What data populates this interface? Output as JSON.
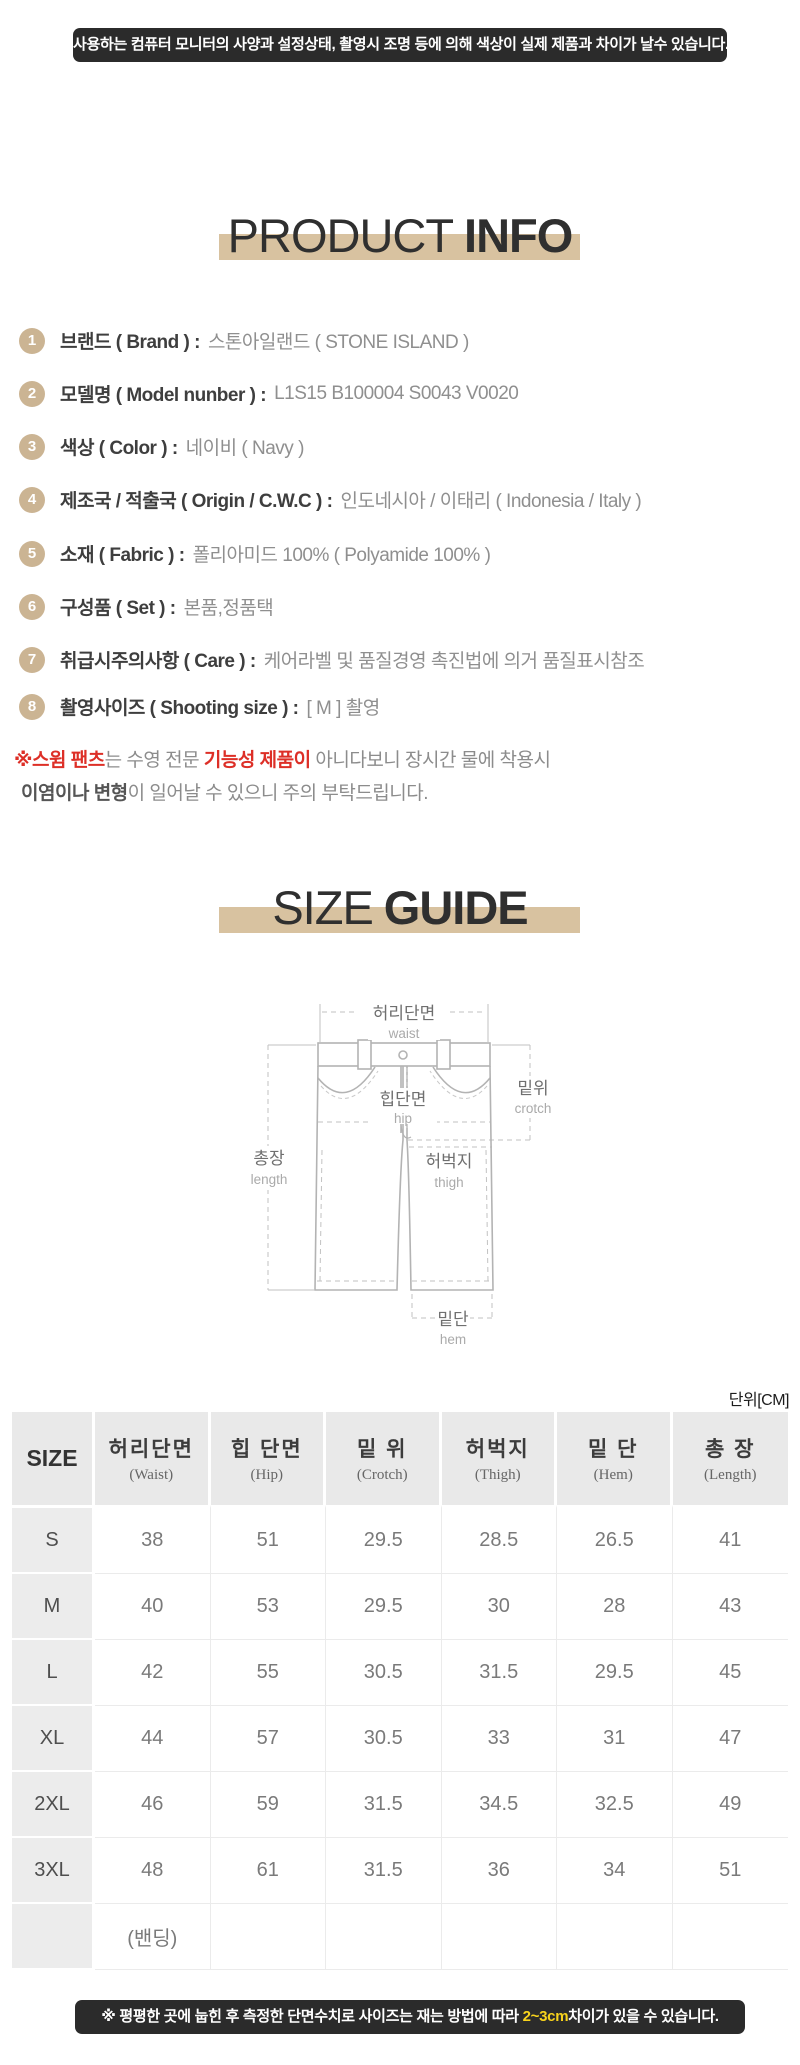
{
  "colors": {
    "accent_tan": "#d8c2a0",
    "badge_tan": "#cbb493",
    "banner_bg": "#2b2b2b",
    "note_red": "#dd2f27",
    "highlight_yellow": "#f8d31c"
  },
  "top_banner": {
    "text": "사용하는 컴퓨터 모니터의 사양과 설정상태, 촬영시 조명 등에 의해 색상이 실제 제품과 차이가 날수 있습니다."
  },
  "product_info": {
    "title": {
      "light": "PRODUCT",
      "bold": "INFO"
    },
    "items": [
      {
        "num": "1",
        "label": "브랜드 ( Brand ) :",
        "value": "스톤아일랜드 ( STONE ISLAND )"
      },
      {
        "num": "2",
        "label": "모델명 ( Model nunber ) :",
        "value": "L1S15 B100004 S0043 V0020"
      },
      {
        "num": "3",
        "label": "색상 ( Color ) :",
        "value": "네이비 ( Navy )"
      },
      {
        "num": "4",
        "label": "제조국 / 적출국 ( Origin / C.W.C ) :",
        "value": "인도네시아 / 이태리 ( Indonesia / Italy )"
      },
      {
        "num": "5",
        "label": "소재 ( Fabric ) :",
        "value": "폴리아미드 100% ( Polyamide 100% )"
      },
      {
        "num": "6",
        "label": "구성품 ( Set ) :",
        "value": "본품,정품택"
      },
      {
        "num": "7",
        "label": "취급시주의사항 ( Care ) :",
        "value": "케어라벨 및 품질경영 촉진법에 의거 품질표시참조"
      },
      {
        "num": "8",
        "label": "촬영사이즈 ( Shooting size ) :",
        "value": "[ M ] 촬영"
      }
    ],
    "note_line1": [
      {
        "text": "※스윔 팬츠",
        "style": "red-bold"
      },
      {
        "text": "는 수영 전문 ",
        "style": "gray"
      },
      {
        "text": "기능성 제품이",
        "style": "red-bold"
      },
      {
        "text": " 아니다보니 장시간 물에 착용시",
        "style": "gray"
      }
    ],
    "note_line2": [
      {
        "text": "이염이나 변형",
        "style": "dark-bold"
      },
      {
        "text": "이 일어날 수 있으니 주의 부탁드립니다.",
        "style": "gray"
      }
    ]
  },
  "size_guide": {
    "title": {
      "light": "SIZE",
      "bold": "GUIDE"
    },
    "diagram": {
      "waist_ko": "허리단면",
      "waist_en": "waist",
      "crotch_ko": "밑위",
      "crotch_en": "crotch",
      "hip_ko": "힙단면",
      "hip_en": "hip",
      "length_ko": "총장",
      "length_en": "length",
      "thigh_ko": "허벅지",
      "thigh_en": "thigh",
      "hem_ko": "밑단",
      "hem_en": "hem"
    },
    "unit_label": "단위[CM]"
  },
  "size_table": {
    "headers": [
      {
        "ko": "SIZE",
        "en": ""
      },
      {
        "ko": "허리단면",
        "en": "(Waist)"
      },
      {
        "ko": "힙 단면",
        "en": "(Hip)"
      },
      {
        "ko": "밑 위",
        "en": "(Crotch)"
      },
      {
        "ko": "허벅지",
        "en": "(Thigh)"
      },
      {
        "ko": "밑 단",
        "en": "(Hem)"
      },
      {
        "ko": "총 장",
        "en": "(Length)"
      }
    ],
    "rows": [
      {
        "size": "S",
        "values": [
          "38",
          "51",
          "29.5",
          "28.5",
          "26.5",
          "41"
        ]
      },
      {
        "size": "M",
        "values": [
          "40",
          "53",
          "29.5",
          "30",
          "28",
          "43"
        ]
      },
      {
        "size": "L",
        "values": [
          "42",
          "55",
          "30.5",
          "31.5",
          "29.5",
          "45"
        ]
      },
      {
        "size": "XL",
        "values": [
          "44",
          "57",
          "30.5",
          "33",
          "31",
          "47"
        ]
      },
      {
        "size": "2XL",
        "values": [
          "46",
          "59",
          "31.5",
          "34.5",
          "32.5",
          "49"
        ]
      },
      {
        "size": "3XL",
        "values": [
          "48",
          "61",
          "31.5",
          "36",
          "34",
          "51"
        ]
      },
      {
        "size": "",
        "values": [
          "(밴딩)",
          "",
          "",
          "",
          "",
          ""
        ]
      }
    ]
  },
  "chart_data": {
    "type": "table",
    "title": "SIZE GUIDE",
    "unit": "CM",
    "columns": [
      "SIZE",
      "허리단면 (Waist)",
      "힙 단면 (Hip)",
      "밑 위 (Crotch)",
      "허벅지 (Thigh)",
      "밑 단 (Hem)",
      "총 장 (Length)"
    ],
    "rows": [
      [
        "S",
        38,
        51,
        29.5,
        28.5,
        26.5,
        41
      ],
      [
        "M",
        40,
        53,
        29.5,
        30,
        28,
        43
      ],
      [
        "L",
        42,
        55,
        30.5,
        31.5,
        29.5,
        45
      ],
      [
        "XL",
        44,
        57,
        30.5,
        33,
        31,
        47
      ],
      [
        "2XL",
        46,
        59,
        31.5,
        34.5,
        32.5,
        49
      ],
      [
        "3XL",
        48,
        61,
        31.5,
        36,
        34,
        51
      ],
      [
        "(밴딩)",
        null,
        null,
        null,
        null,
        null,
        null
      ]
    ]
  },
  "bottom_banner": {
    "parts": [
      {
        "text": "※ 평평한 곳에 눕힌 후 측정한 단면수치로 사이즈는 재는 방법에 따라 ",
        "style": "white"
      },
      {
        "text": "2~3cm",
        "style": "yellow"
      },
      {
        "text": "차이가 있을 수 있습니다.",
        "style": "white"
      }
    ]
  }
}
